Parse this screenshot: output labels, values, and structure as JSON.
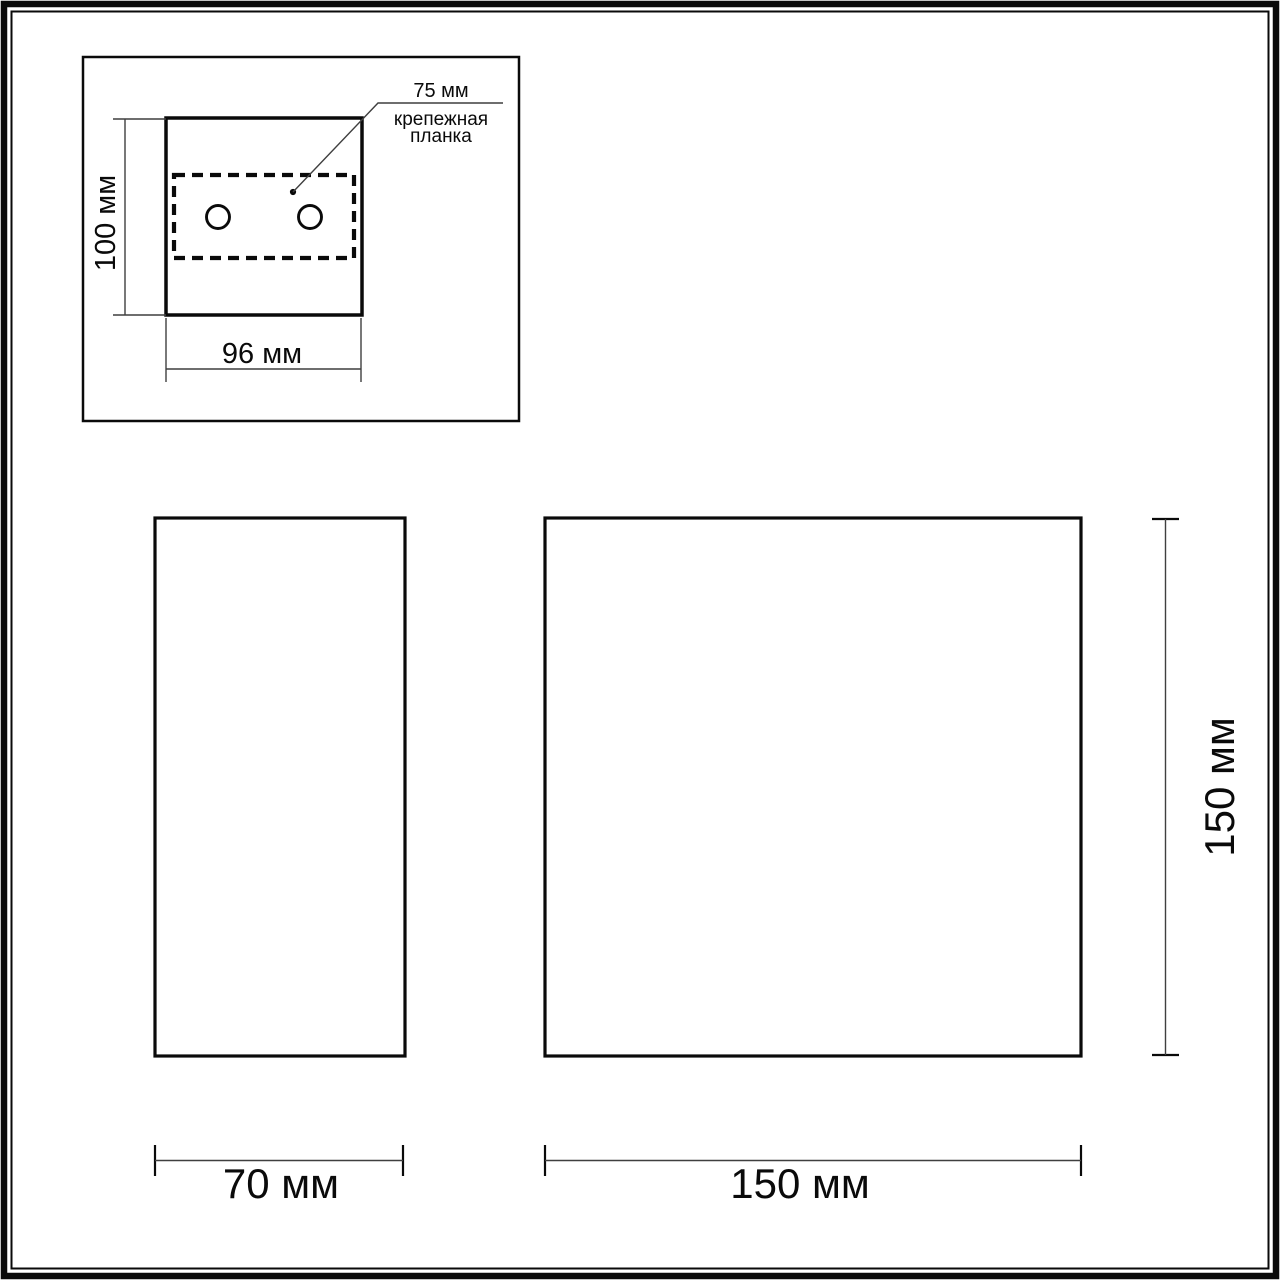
{
  "colors": {
    "line": "#0a0a0a",
    "dim": "#3f3f3f",
    "background": "#ffffff"
  },
  "inset": {
    "height_label": "100 мм",
    "width_label": "96 мм",
    "hole_spacing_label": "75 мм",
    "plate_label_line1": "крепежная",
    "plate_label_line2": "планка"
  },
  "side_view": {
    "width_label": "70 мм"
  },
  "front_view": {
    "width_label": "150 мм",
    "height_label": "150 мм"
  }
}
